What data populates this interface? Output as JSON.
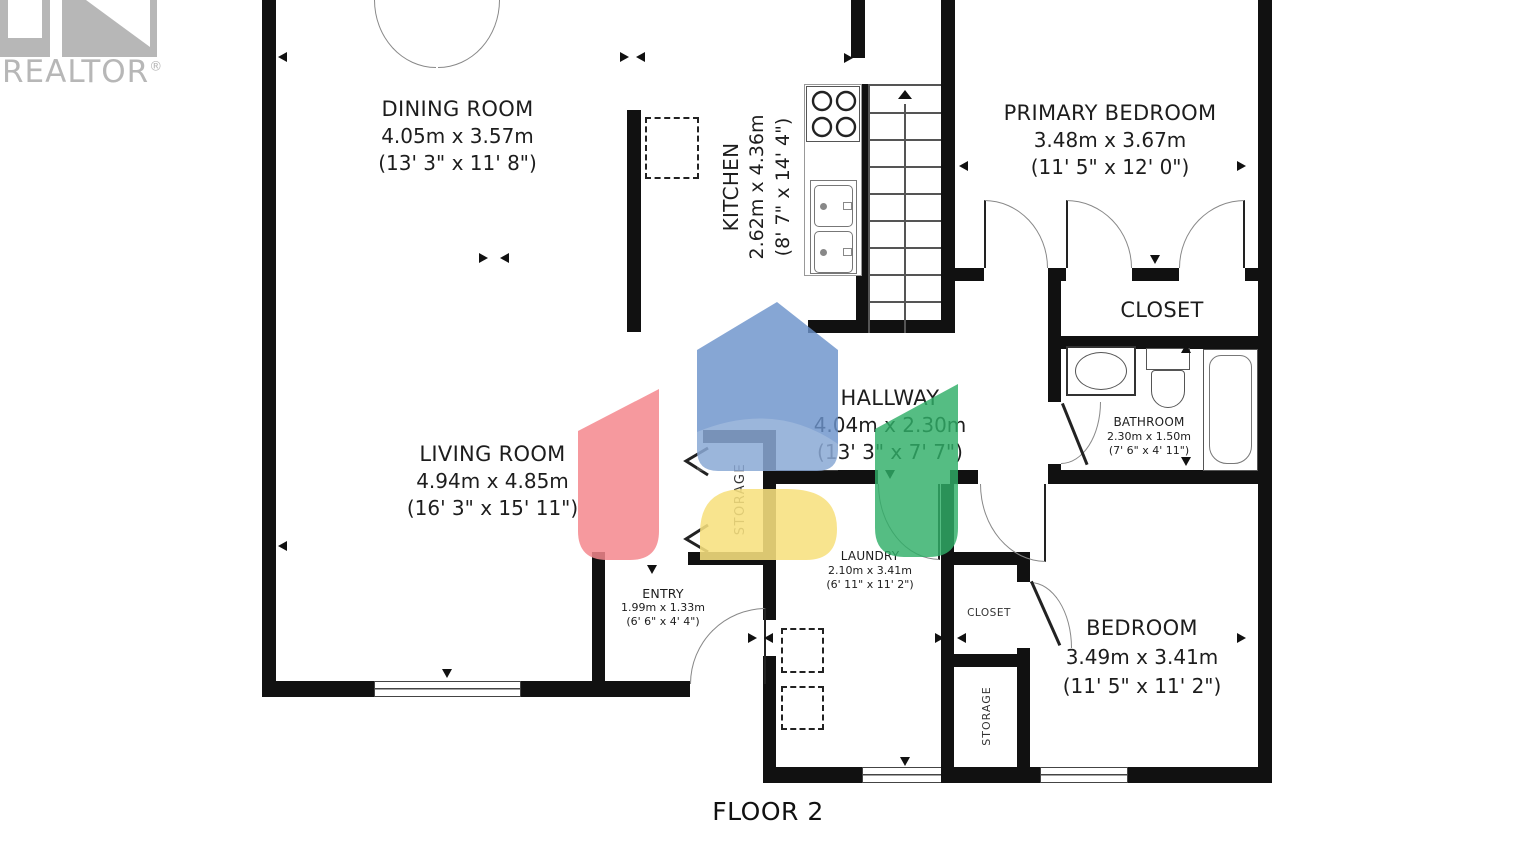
{
  "brand": {
    "name": "REALTOR",
    "registered": "®"
  },
  "floor_label": "FLOOR 2",
  "rooms": {
    "dining": {
      "name": "DINING ROOM",
      "metric": "4.05m x 3.57m",
      "imperial": "(13' 3\" x 11' 8\")"
    },
    "kitchen": {
      "name": "KITCHEN",
      "metric": "2.62m x 4.36m",
      "imperial": "(8' 7\" x 14' 4\")"
    },
    "primary": {
      "name": "PRIMARY BEDROOM",
      "metric": "3.48m x 3.67m",
      "imperial": "(11' 5\" x 12' 0\")"
    },
    "closet_primary": {
      "name": "CLOSET"
    },
    "bathroom": {
      "name": "BATHROOM",
      "metric": "2.30m x 1.50m",
      "imperial": "(7' 6\" x 4' 11\")"
    },
    "hallway": {
      "name": "HALLWAY",
      "metric": "4.04m x 2.30m",
      "imperial": "(13' 3\" x 7' 7\")"
    },
    "living": {
      "name": "LIVING ROOM",
      "metric": "4.94m x 4.85m",
      "imperial": "(16' 3\" x 15' 11\")"
    },
    "storage_hall": {
      "name": "STORAGE"
    },
    "entry": {
      "name": "ENTRY",
      "metric": "1.99m x 1.33m",
      "imperial": "(6' 6\" x 4' 4\")"
    },
    "laundry": {
      "name": "LAUNDRY",
      "metric": "2.10m x 3.41m",
      "imperial": "(6' 11\" x 11' 2\")"
    },
    "closet_bedroom": {
      "name": "CLOSET"
    },
    "storage_bedroom": {
      "name": "STORAGE"
    },
    "bedroom": {
      "name": "BEDROOM",
      "metric": "3.49m x 3.41m",
      "imperial": "(11' 5\" x 11' 2\")"
    }
  },
  "palette": {
    "wall": "#111111",
    "label_text": "#1d1d1d",
    "logo_gray": "#b7b7b7",
    "watermark": {
      "blue": "#6b92cb",
      "red": "#f5878d",
      "yellow": "#f7e07e",
      "green": "#2fae68"
    }
  }
}
